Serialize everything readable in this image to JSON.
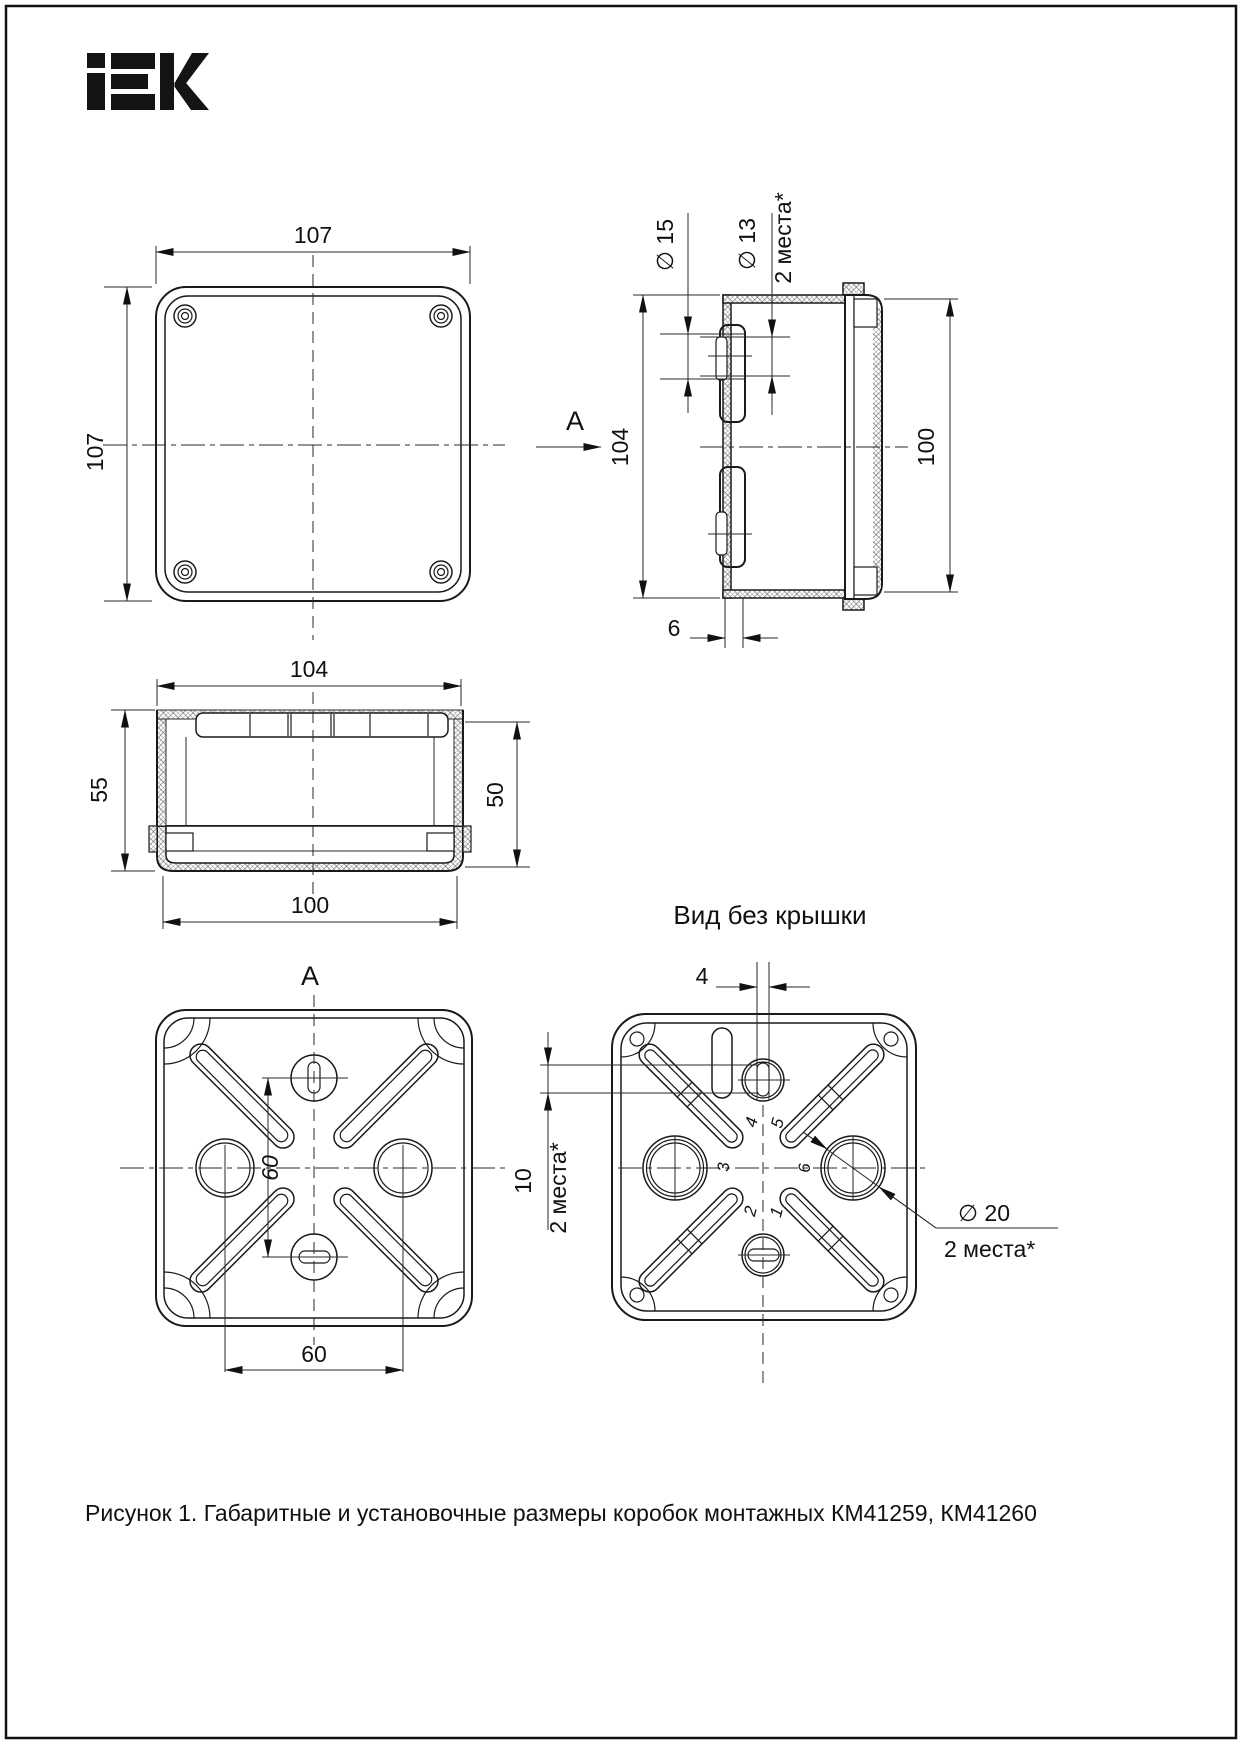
{
  "page": {
    "caption": "Рисунок 1. Габаритные и установочные размеры коробок монтажных КМ41259, КМ41260"
  },
  "logo": {
    "name": "IEK"
  },
  "top_view": {
    "dim_width": "107",
    "dim_height": "107"
  },
  "side_view": {
    "label_d15": "∅ 15",
    "label_d13": "∅ 13",
    "label_places": "2 места*",
    "dim_height": "104",
    "dim_cover_height": "100",
    "dim_bottom": "6",
    "arrow_label": "A"
  },
  "front_view": {
    "dim_width_top": "104",
    "dim_height_left": "55",
    "dim_height_right": "50",
    "dim_width_bottom": "100",
    "view_label": "A"
  },
  "view_a": {
    "dim_vertical": "60",
    "dim_horizontal": "60"
  },
  "open_view": {
    "title": "Вид без крышки",
    "dim_slot_width": "4",
    "dim_slot_height": "10",
    "label_places_10": "2 места*",
    "label_d20": "∅ 20",
    "label_places_20": "2 места*",
    "mold_numbers": [
      "1",
      "2",
      "3",
      "4",
      "5",
      "6"
    ]
  }
}
